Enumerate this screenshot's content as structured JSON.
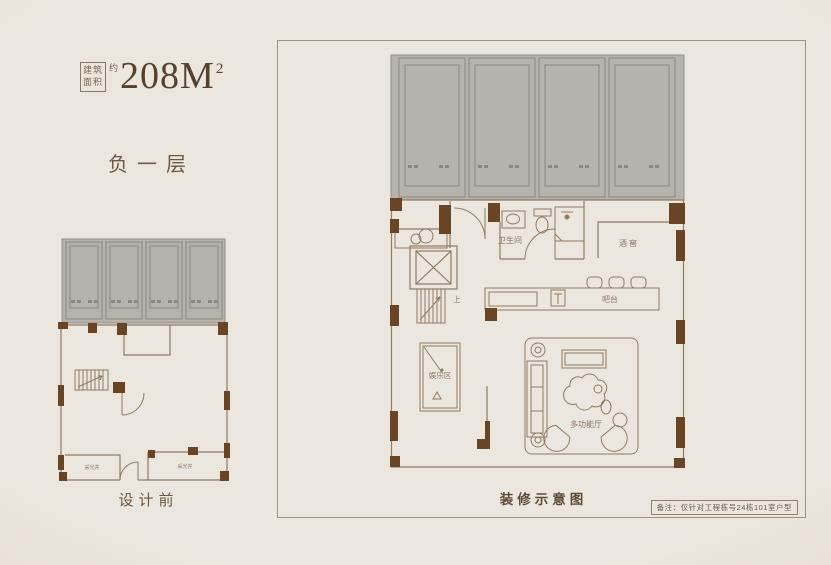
{
  "colors": {
    "background": "#ECE7DE",
    "panel_border": "#A3927B",
    "title_brown": "#54422E",
    "label_brown": "#8A7464",
    "wall_brown": "#6A4525",
    "line_brown": "#8F7A64",
    "parking_gray": "#B6B2AC"
  },
  "header": {
    "area_boxed_label": "建筑面积",
    "area_approx": "约",
    "area_value": "208M",
    "area_sup": "2",
    "floor_title": "负一层"
  },
  "left_plan": {
    "caption": "设计前",
    "rooms": {
      "lightwell_left": "采光井",
      "lightwell_right": "采光井"
    }
  },
  "right_plan": {
    "caption": "装修示意图",
    "note": "备注：仅针对工程栋号24栋101室户型",
    "rooms": {
      "bathroom": "卫生间",
      "wine_cellar": "酒窖",
      "bar": "吧台",
      "entertainment": "娱乐区",
      "multi_hall": "多功能厅",
      "stairs_up": "上"
    }
  }
}
